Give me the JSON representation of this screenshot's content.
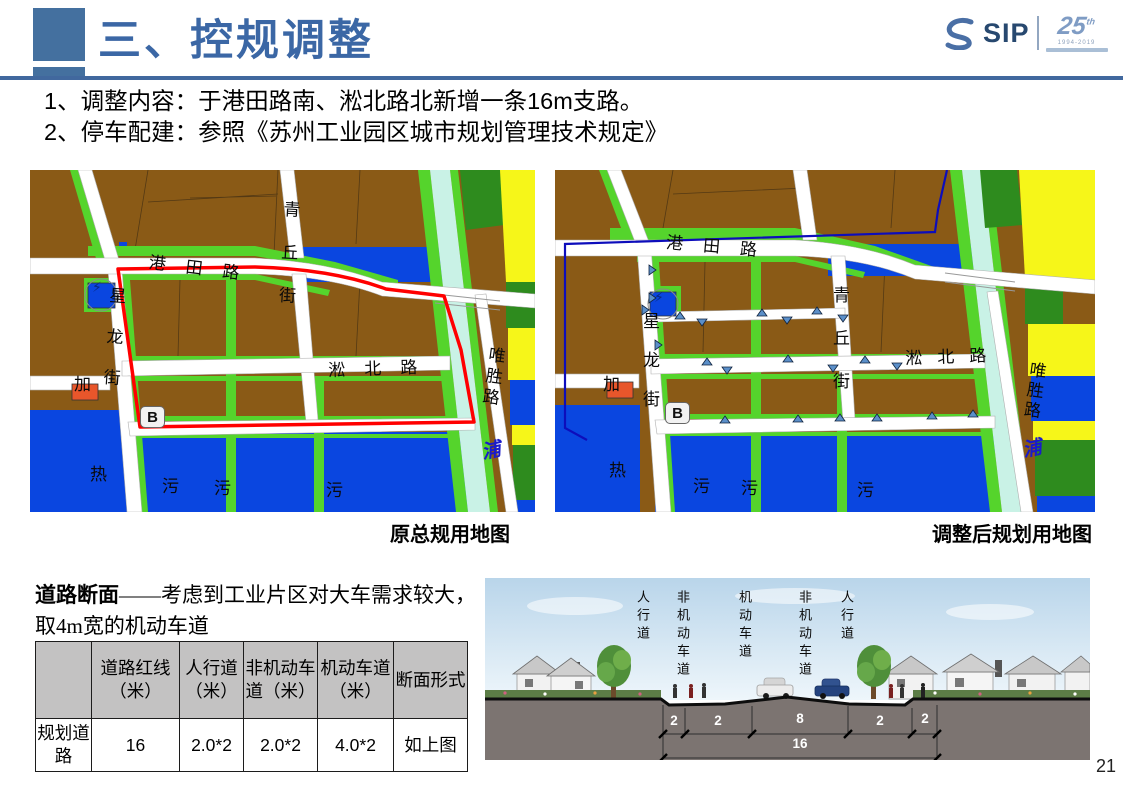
{
  "header": {
    "title": "三、控规调整",
    "accent_color": "#3b67a5"
  },
  "logo": {
    "sip": "SIP",
    "anniversary": "25",
    "suffix": "th",
    "years": "1994-2019"
  },
  "bullets": [
    "1、调整内容：于港田路南、淞北路北新增一条16m支路。",
    "2、停车配建：参照《苏州工业园区城市规划管理技术规定》"
  ],
  "maps": {
    "road_names": {
      "gangtian": "港田路",
      "qingqiu": "青丘街",
      "xinglong": "星龙街",
      "songbei": "淞北路",
      "weisheng": "唯胜路"
    },
    "area_names": {
      "jia": "加",
      "b": "B",
      "re": "热",
      "wu": "污",
      "pu": "浦",
      "bolt": "⚡"
    },
    "left": {
      "caption": "原总规用地图"
    },
    "right": {
      "caption": "调整后规划用地图"
    },
    "colors": {
      "industrial_brown": "#8a5a16",
      "green_strip": "#55d42c",
      "dark_green": "#2e8b1e",
      "water_parcel_blue": "#0a46e0",
      "river_cyan": "#c9f2e6",
      "farm_yellow": "#f6f619",
      "boundary_red": "#ff0000",
      "boundary_navy": "#0d0dbb",
      "marker_blue": "#5b8fc9",
      "gas_orange": "#e8562b"
    }
  },
  "section": {
    "heading_bold": "道路断面",
    "heading_rest": "——考虑到工业片区对大车需求较大，取4m宽的机动车道"
  },
  "table": {
    "headers": [
      "",
      "道路红线（米）",
      "人行道（米）",
      "非机动车道（米）",
      "机动车道（米）",
      "断面形式"
    ],
    "row": [
      "规划道路",
      "16",
      "2.0*2",
      "2.0*2",
      "4.0*2",
      "如上图"
    ]
  },
  "cross_section": {
    "lanes": [
      "人行道",
      "非机动车道",
      "机动车道",
      "非机动车道",
      "人行道"
    ],
    "dims": [
      "2",
      "2",
      "8",
      "2",
      "2"
    ],
    "total": "16"
  },
  "page_number": "21"
}
